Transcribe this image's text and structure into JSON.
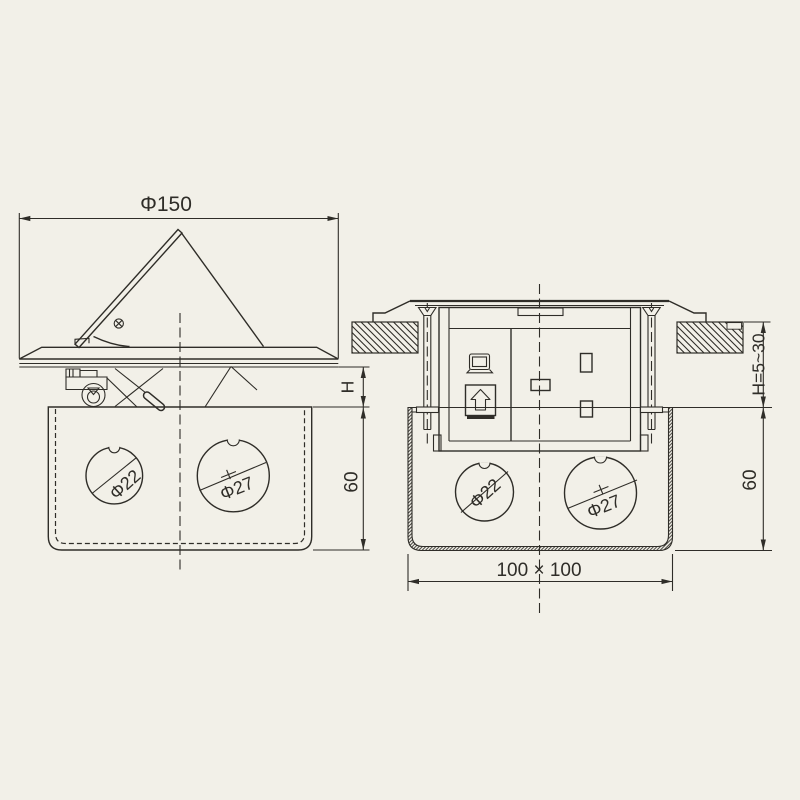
{
  "canvas": {
    "background_color": "#f2f0e8",
    "line_color": "#2f2d28"
  },
  "side_view": {
    "dim_lid_diameter": "Φ150",
    "dim_popup_height": "H",
    "dim_box_depth": "60",
    "knockout_small": "Φ22",
    "knockout_large": "Φ27"
  },
  "section_view": {
    "dim_mounting_depth": "H=5~30",
    "dim_box_depth": "60",
    "dim_box_footprint": "100 × 100",
    "knockout_small": "Φ22",
    "knockout_large": "Φ27"
  },
  "icons": {
    "lid_screw": "phillips-screw-icon",
    "socket_data": "computer-icon",
    "socket_eject": "eject-arrow-icon",
    "socket_power": "uk-socket-slots"
  }
}
